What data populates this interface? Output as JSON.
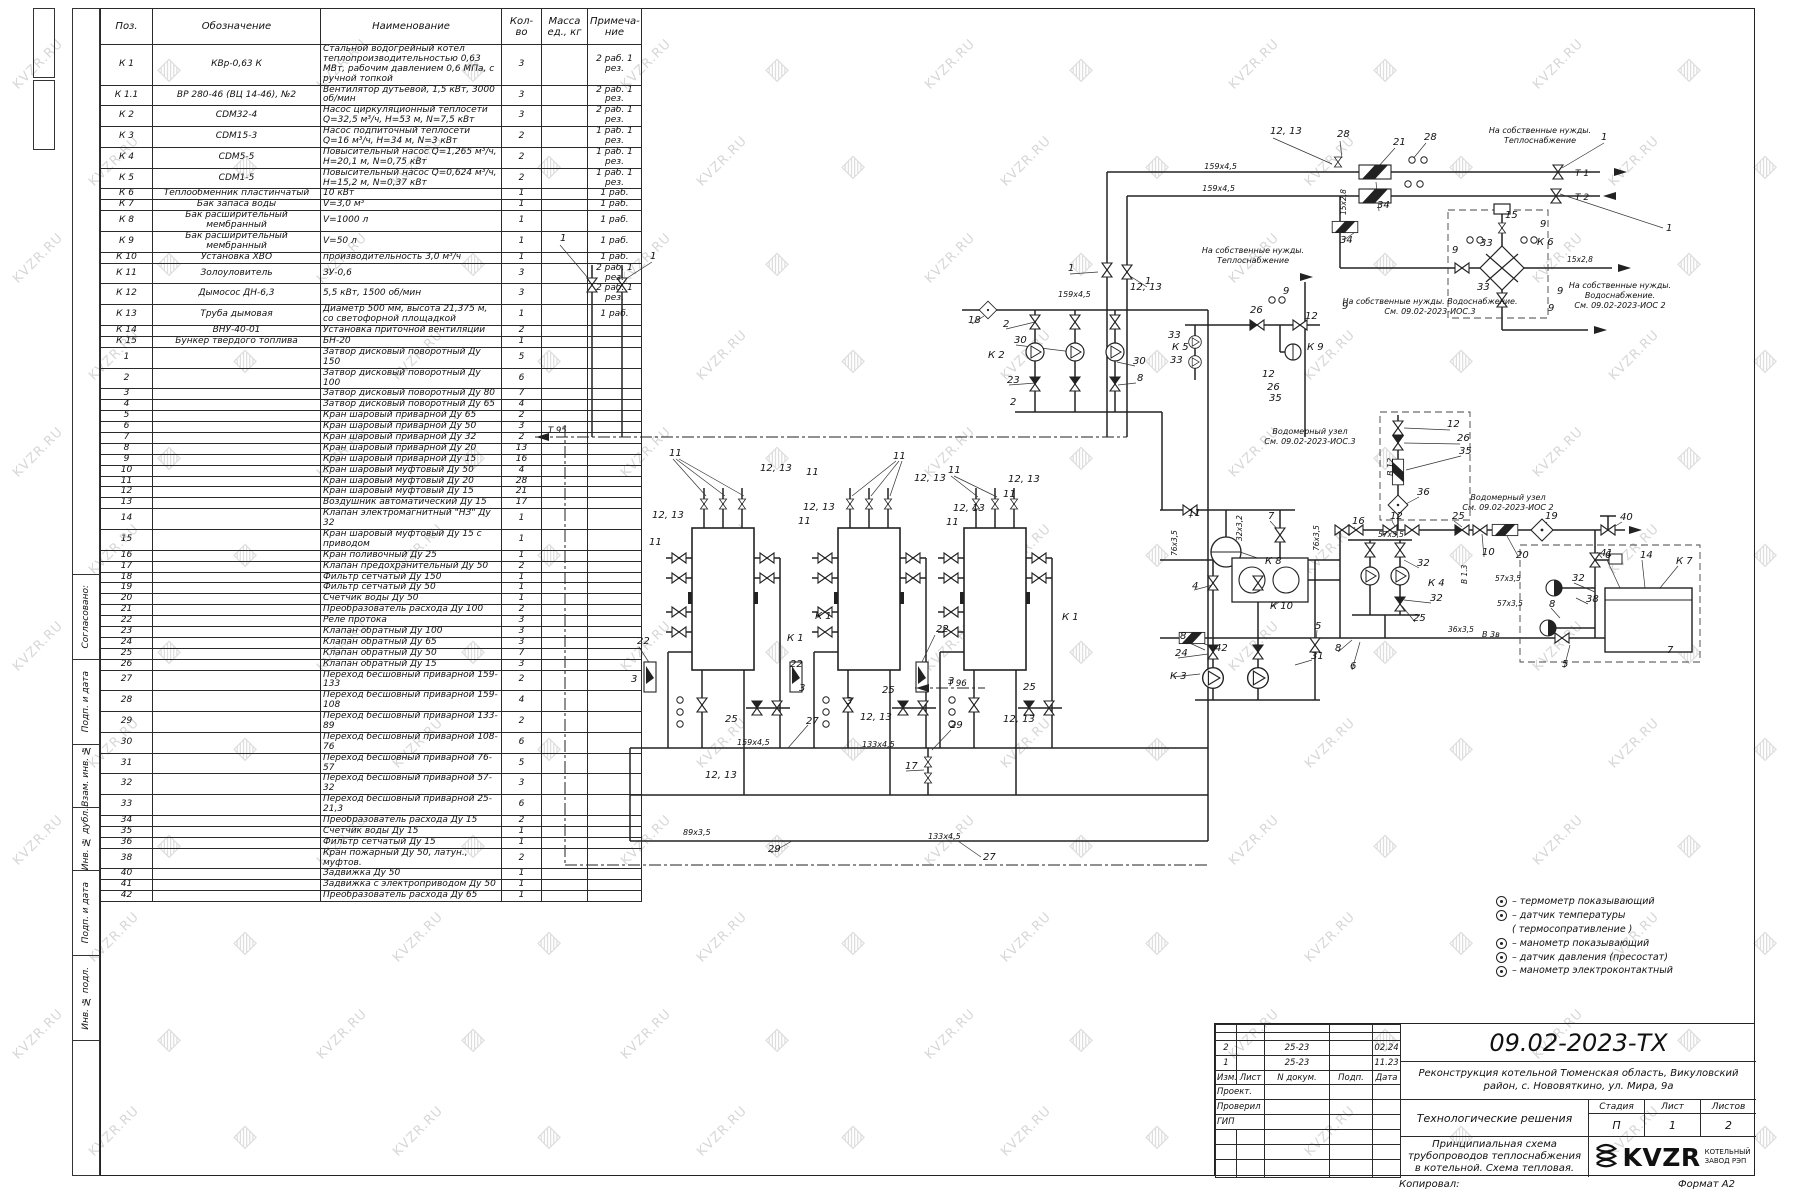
{
  "watermark": {
    "text": "KVZR.RU"
  },
  "side_strip": {
    "labels": [
      "Согласовано:",
      "Подп. и дата",
      "Взам. инв. №",
      "Инв. № дубл.",
      "Подп. и дата",
      "Инв. № подл."
    ]
  },
  "spec_table": {
    "headers": [
      "Поз.",
      "Обозначение",
      "Наименование",
      "Кол-во",
      "Масса ед., кг",
      "Примеча- ние"
    ],
    "rows": [
      [
        "К 1",
        "КВр-0,63 К",
        "Стальной водогрейный котел теплопроизводительностью 0,63 МВт, рабочим давлением 0,6 МПа, с ручной топкой",
        "3",
        "",
        "2 раб. 1 рез."
      ],
      [
        "К 1.1",
        "ВР 280-46 (ВЦ 14-46), №2",
        "Вентилятор дутьевой, 1,5 кВт, 3000 об/мин",
        "3",
        "",
        "2 раб. 1 рез."
      ],
      [
        "К 2",
        "CDM32-4",
        "Насос циркуляционный теплосети Q=32,5 м³/ч, H=53 м, N=7,5 кВт",
        "3",
        "",
        "2 раб. 1 рез."
      ],
      [
        "К 3",
        "CDM15-3",
        "Насос подпиточный теплосети Q=16 м³/ч, H=34 м, N=3 кВт",
        "2",
        "",
        "1 раб. 1 рез."
      ],
      [
        "К 4",
        "CDM5-5",
        "Повысительный насос Q=1,265 м³/ч, H=20,1 м, N=0,75 кВт",
        "2",
        "",
        "1 раб. 1 рез."
      ],
      [
        "К 5",
        "CDM1-5",
        "Повысительный насос Q=0,624 м³/ч, H=15,2 м, N=0,37 кВт",
        "2",
        "",
        "1 раб. 1 рез."
      ],
      [
        "К 6",
        "Теплообменник пластинчатый",
        "10 кВт",
        "1",
        "",
        "1 раб."
      ],
      [
        "К 7",
        "Бак запаса воды",
        "V=3,0 м³",
        "1",
        "",
        "1 раб."
      ],
      [
        "К 8",
        "Бак расширительный мембранный",
        "V=1000 л",
        "1",
        "",
        "1 раб."
      ],
      [
        "К 9",
        "Бак расширительный мембранный",
        "V=50 л",
        "1",
        "",
        "1 раб."
      ],
      [
        "К 10",
        "Установка ХВО",
        "производительность 3,0 м³/ч",
        "1",
        "",
        "1 раб."
      ],
      [
        "К 11",
        "Золоуловитель",
        "ЗУ-0,6",
        "3",
        "",
        "2 раб. 1 рез."
      ],
      [
        "К 12",
        "Дымосос ДН-6,3",
        "5,5 кВт, 1500 об/мин",
        "3",
        "",
        "2 раб. 1 рез."
      ],
      [
        "К 13",
        "Труба дымовая",
        "Диаметр 500 мм, высота 21,375 м, со светофорной площадкой",
        "1",
        "",
        "1 раб."
      ],
      [
        "К 14",
        "ВНУ-40-01",
        "Установка приточной вентиляции",
        "2",
        "",
        ""
      ],
      [
        "К 15",
        "Бункер твердого топлива",
        "БН-20",
        "1",
        "",
        ""
      ],
      [
        "1",
        "",
        "Затвор дисковый поворотный Ду 150",
        "5",
        "",
        ""
      ],
      [
        "2",
        "",
        "Затвор дисковый поворотный Ду 100",
        "6",
        "",
        ""
      ],
      [
        "3",
        "",
        "Затвор дисковый поворотный Ду 80",
        "7",
        "",
        ""
      ],
      [
        "4",
        "",
        "Затвор дисковый поворотный Ду 65",
        "4",
        "",
        ""
      ],
      [
        "5",
        "",
        "Кран шаровый приварной Ду 65",
        "2",
        "",
        ""
      ],
      [
        "6",
        "",
        "Кран шаровый приварной Ду 50",
        "3",
        "",
        ""
      ],
      [
        "7",
        "",
        "Кран шаровый приварной Ду 32",
        "2",
        "",
        ""
      ],
      [
        "8",
        "",
        "Кран шаровый приварной Ду 20",
        "13",
        "",
        ""
      ],
      [
        "9",
        "",
        "Кран шаровый приварной Ду 15",
        "16",
        "",
        ""
      ],
      [
        "10",
        "",
        "Кран шаровый муфтовый Ду 50",
        "4",
        "",
        ""
      ],
      [
        "11",
        "",
        "Кран шаровый муфтовый Ду 20",
        "28",
        "",
        ""
      ],
      [
        "12",
        "",
        "Кран шаровый муфтовый Ду 15",
        "21",
        "",
        ""
      ],
      [
        "13",
        "",
        "Воздушник автоматический Ду 15",
        "17",
        "",
        ""
      ],
      [
        "14",
        "",
        "Клапан электромагнитный \"НЗ\" Ду 32",
        "1",
        "",
        ""
      ],
      [
        "15",
        "",
        "Кран шаровый муфтовый Ду 15 с приводом",
        "1",
        "",
        ""
      ],
      [
        "16",
        "",
        "Кран поливочный Ду 25",
        "1",
        "",
        ""
      ],
      [
        "17",
        "",
        "Клапан предохранительный Ду 50",
        "2",
        "",
        ""
      ],
      [
        "18",
        "",
        "Фильтр сетчатый Ду 150",
        "1",
        "",
        ""
      ],
      [
        "19",
        "",
        "Фильтр сетчатый Ду 50",
        "1",
        "",
        ""
      ],
      [
        "20",
        "",
        "Счетчик воды Ду 50",
        "1",
        "",
        ""
      ],
      [
        "21",
        "",
        "Преобразователь расхода Ду 100",
        "2",
        "",
        ""
      ],
      [
        "22",
        "",
        "Реле протока",
        "3",
        "",
        ""
      ],
      [
        "23",
        "",
        "Клапан обратный Ду 100",
        "3",
        "",
        ""
      ],
      [
        "24",
        "",
        "Клапан обратный Ду 65",
        "3",
        "",
        ""
      ],
      [
        "25",
        "",
        "Клапан обратный Ду 50",
        "7",
        "",
        ""
      ],
      [
        "26",
        "",
        "Клапан обратный Ду 15",
        "3",
        "",
        ""
      ],
      [
        "27",
        "",
        "Переход бесшовный приварной 159-133",
        "2",
        "",
        ""
      ],
      [
        "28",
        "",
        "Переход бесшовный приварной 159-108",
        "4",
        "",
        ""
      ],
      [
        "29",
        "",
        "Переход бесшовный приварной 133-89",
        "2",
        "",
        ""
      ],
      [
        "30",
        "",
        "Переход бесшовный приварной 108-76",
        "6",
        "",
        ""
      ],
      [
        "31",
        "",
        "Переход бесшовный приварной 76-57",
        "5",
        "",
        ""
      ],
      [
        "32",
        "",
        "Переход бесшовный приварной 57-32",
        "3",
        "",
        ""
      ],
      [
        "33",
        "",
        "Переход бесшовный приварной 25-21,3",
        "6",
        "",
        ""
      ],
      [
        "34",
        "",
        "Преобразователь расхода Ду 15",
        "2",
        "",
        ""
      ],
      [
        "35",
        "",
        "Счетчик воды Ду 15",
        "1",
        "",
        ""
      ],
      [
        "36",
        "",
        "Фильтр сетчатый Ду 15",
        "1",
        "",
        ""
      ],
      [
        "38",
        "",
        "Кран пожарный Ду 50, латун., муфтов.",
        "2",
        "",
        ""
      ],
      [
        "40",
        "",
        "Задвижка Ду 50",
        "1",
        "",
        ""
      ],
      [
        "41",
        "",
        "Задвижка с электроприводом Ду 50",
        "1",
        "",
        ""
      ],
      [
        "42",
        "",
        "Преобразователь расхода Ду 65",
        "1",
        "",
        ""
      ]
    ]
  },
  "legend": {
    "items": [
      {
        "icon": true,
        "label": "– термометр показывающий"
      },
      {
        "icon": true,
        "label": "– датчик температуры"
      },
      {
        "icon": false,
        "label": "( термосопративление )"
      },
      {
        "icon": true,
        "label": "– манометр показывающий"
      },
      {
        "icon": true,
        "label": "– датчик давления (пресостат)"
      },
      {
        "icon": true,
        "label": "– манометр электроконтактный"
      }
    ]
  },
  "schematic": {
    "labels": [
      [
        560,
        241,
        "1"
      ],
      [
        650,
        259,
        "1"
      ],
      [
        548,
        433,
        "Т 95",
        8.5
      ],
      [
        669,
        456,
        "11"
      ],
      [
        760,
        471,
        "12, 13"
      ],
      [
        806,
        475,
        "11"
      ],
      [
        893,
        459,
        "11"
      ],
      [
        914,
        481,
        "12, 13"
      ],
      [
        948,
        473,
        "11"
      ],
      [
        652,
        518,
        "12, 13"
      ],
      [
        649,
        545,
        "11"
      ],
      [
        803,
        510,
        "12, 13"
      ],
      [
        798,
        524,
        "11"
      ],
      [
        953,
        511,
        "12, 13"
      ],
      [
        946,
        525,
        "11"
      ],
      [
        1008,
        482,
        "12, 13"
      ],
      [
        1003,
        497,
        "11"
      ],
      [
        787,
        641,
        "К 1"
      ],
      [
        815,
        619,
        "К 1"
      ],
      [
        1062,
        620,
        "К 1"
      ],
      [
        637,
        644,
        "22"
      ],
      [
        790,
        667,
        "22"
      ],
      [
        936,
        632,
        "22"
      ],
      [
        631,
        682,
        "3"
      ],
      [
        799,
        691,
        "3"
      ],
      [
        846,
        704,
        "3"
      ],
      [
        948,
        684,
        "3"
      ],
      [
        725,
        722,
        "25"
      ],
      [
        882,
        693,
        "25"
      ],
      [
        1023,
        690,
        "25"
      ],
      [
        806,
        724,
        "27"
      ],
      [
        860,
        720,
        "12, 13"
      ],
      [
        950,
        728,
        "29"
      ],
      [
        1003,
        722,
        "12, 13"
      ],
      [
        705,
        778,
        "12, 13"
      ],
      [
        737,
        745,
        "159х4,5",
        8
      ],
      [
        862,
        747,
        "133х4,5",
        8
      ],
      [
        683,
        835,
        "89х3,5",
        8
      ],
      [
        928,
        839,
        "133х4,5",
        8
      ],
      [
        768,
        852,
        "29"
      ],
      [
        983,
        860,
        "27"
      ],
      [
        905,
        769,
        "17"
      ],
      [
        948,
        686,
        "Т 96",
        8.5
      ],
      [
        1068,
        271,
        "1"
      ],
      [
        1145,
        284,
        "1"
      ],
      [
        1130,
        290,
        "12, 13"
      ],
      [
        1058,
        297,
        "159х4,5",
        8
      ],
      [
        968,
        323,
        "18"
      ],
      [
        1003,
        327,
        "2"
      ],
      [
        1014,
        343,
        "30"
      ],
      [
        988,
        358,
        "К 2"
      ],
      [
        1007,
        383,
        "23"
      ],
      [
        1010,
        405,
        "2"
      ],
      [
        1133,
        364,
        "30"
      ],
      [
        1137,
        381,
        "8"
      ],
      [
        1168,
        338,
        "33"
      ],
      [
        1172,
        350,
        "К 5"
      ],
      [
        1170,
        363,
        "33"
      ],
      [
        1250,
        313,
        "26"
      ],
      [
        1283,
        294,
        "9"
      ],
      [
        1305,
        319,
        "12"
      ],
      [
        1307,
        350,
        "К 9"
      ],
      [
        1262,
        377,
        "12"
      ],
      [
        1267,
        390,
        "26"
      ],
      [
        1269,
        401,
        "35"
      ],
      [
        1237,
        169,
        "159х4,5",
        8,
        "end"
      ],
      [
        1235,
        191,
        "159х4,5",
        8,
        "end"
      ],
      [
        1270,
        134,
        "12, 13"
      ],
      [
        1337,
        137,
        "28"
      ],
      [
        1393,
        145,
        "21"
      ],
      [
        1424,
        140,
        "28"
      ],
      [
        1377,
        208,
        "34"
      ],
      [
        1340,
        243,
        "34"
      ],
      [
        1346,
        215,
        "15х2,8",
        7.5,
        null,
        -90
      ],
      [
        1540,
        133,
        "На собственные нужды.",
        8,
        "middle"
      ],
      [
        1540,
        143,
        "Теплоснабжение",
        8,
        "middle"
      ],
      [
        1601,
        140,
        "1"
      ],
      [
        1575,
        176,
        "Т 1",
        9
      ],
      [
        1575,
        200,
        "Т 2",
        9
      ],
      [
        1666,
        231,
        "1"
      ],
      [
        1253,
        253,
        "На собственные нужды.",
        8,
        "middle"
      ],
      [
        1253,
        263,
        "Теплоснабжение",
        8,
        "middle"
      ],
      [
        1505,
        218,
        "15"
      ],
      [
        1540,
        227,
        "9"
      ],
      [
        1480,
        246,
        "33"
      ],
      [
        1537,
        245,
        "К 6"
      ],
      [
        1452,
        253,
        "9"
      ],
      [
        1477,
        290,
        "33"
      ],
      [
        1557,
        294,
        "9"
      ],
      [
        1548,
        311,
        "9"
      ],
      [
        1567,
        262,
        "15х2,8",
        7.5
      ],
      [
        1620,
        288,
        "На собственные нужды.",
        8,
        "middle"
      ],
      [
        1620,
        298,
        "Водоснабжение.",
        8,
        "middle"
      ],
      [
        1620,
        308,
        "См. 09.02-2023-ИОС 2",
        8,
        "middle"
      ],
      [
        1430,
        304,
        "На собственные нужды. Водоснабжение.",
        8,
        "middle"
      ],
      [
        1430,
        314,
        "См. 09.02-2023-ИОС.3",
        8,
        "middle"
      ],
      [
        1342,
        309,
        "9"
      ],
      [
        1310,
        434,
        "Водомерный узел",
        8,
        "middle"
      ],
      [
        1310,
        444,
        "См. 09.02-2023-ИОС.3",
        8,
        "middle"
      ],
      [
        1447,
        427,
        "12"
      ],
      [
        1457,
        441,
        "26"
      ],
      [
        1459,
        454,
        "35"
      ],
      [
        1393,
        476,
        "В 12",
        8,
        null,
        -90
      ],
      [
        1417,
        495,
        "36"
      ],
      [
        1390,
        519,
        "12"
      ],
      [
        1352,
        524,
        "16"
      ],
      [
        1378,
        537,
        "57х3,5",
        7.5
      ],
      [
        1452,
        519,
        "25"
      ],
      [
        1482,
        555,
        "10"
      ],
      [
        1516,
        558,
        "20"
      ],
      [
        1545,
        519,
        "19"
      ],
      [
        1620,
        520,
        "40"
      ],
      [
        1600,
        556,
        "41"
      ],
      [
        1586,
        602,
        "38"
      ],
      [
        1508,
        500,
        "Водомерный узел",
        8,
        "middle"
      ],
      [
        1508,
        510,
        "См. 09.02-2023-ИОС 2",
        8,
        "middle"
      ],
      [
        1467,
        584,
        "В 1.3",
        7.5,
        null,
        -90
      ],
      [
        1495,
        581,
        "57х3,5",
        7.5
      ],
      [
        1497,
        606,
        "57х3,5",
        7.5
      ],
      [
        1417,
        566,
        "32"
      ],
      [
        1430,
        601,
        "32"
      ],
      [
        1428,
        586,
        "К 4"
      ],
      [
        1413,
        621,
        "25"
      ],
      [
        1335,
        651,
        "8"
      ],
      [
        1350,
        669,
        "6"
      ],
      [
        1188,
        516,
        "11"
      ],
      [
        1268,
        519,
        "7"
      ],
      [
        1265,
        564,
        "К 8"
      ],
      [
        1319,
        551,
        "76х3,5",
        7.5,
        null,
        -90
      ],
      [
        1242,
        541,
        "32х3,2",
        7.5,
        null,
        -90
      ],
      [
        1177,
        556,
        "76х3,5",
        7.5,
        null,
        -90
      ],
      [
        1192,
        589,
        "4"
      ],
      [
        1315,
        629,
        "5"
      ],
      [
        1180,
        639,
        "8"
      ],
      [
        1175,
        656,
        "24"
      ],
      [
        1311,
        659,
        "31"
      ],
      [
        1170,
        679,
        "К 3"
      ],
      [
        1270,
        609,
        "К 10"
      ],
      [
        1215,
        651,
        "42"
      ],
      [
        1448,
        632,
        "36х3,5",
        7.5
      ],
      [
        1482,
        637,
        "В 3в",
        8
      ],
      [
        1562,
        667,
        "5"
      ],
      [
        1667,
        653,
        "7"
      ],
      [
        1676,
        564,
        "К 7"
      ],
      [
        1640,
        558,
        "14"
      ],
      [
        1605,
        558,
        "6"
      ],
      [
        1572,
        581,
        "32"
      ],
      [
        1549,
        607,
        "8"
      ]
    ]
  },
  "title_block": {
    "doc_number": "09.02-2023-ТХ",
    "project": "Реконструкция котельной  Тюменская область, Викуловский район, с. Нововяткино, ул. Мира, 9а",
    "section": "Технологические решения",
    "sheet_title": "Принципиальная схема трубопроводов теплоснабжения в котельной. Схема тепловая.",
    "stage_label": "Стадия",
    "stage": "П",
    "sheet_label": "Лист",
    "sheet": "1",
    "sheets_label": "Листов",
    "sheets": "2",
    "rev_rows": [
      [
        "2",
        "",
        "25-23",
        "",
        "02.24"
      ],
      [
        "1",
        "",
        "25-23",
        "",
        "11.23"
      ]
    ],
    "rev_header": [
      "Изм.",
      "Лист",
      "N докум.",
      "Подп.",
      "Дата"
    ],
    "roles": [
      "Проект.",
      "Проверил",
      "ГИП"
    ],
    "logo_text": "KVZR",
    "logo_caption_1": "КОТЕЛЬНЫЙ",
    "logo_caption_2": "ЗАВОД РЭП",
    "copied_label": "Копировал:",
    "format_label": "Формат А2"
  }
}
